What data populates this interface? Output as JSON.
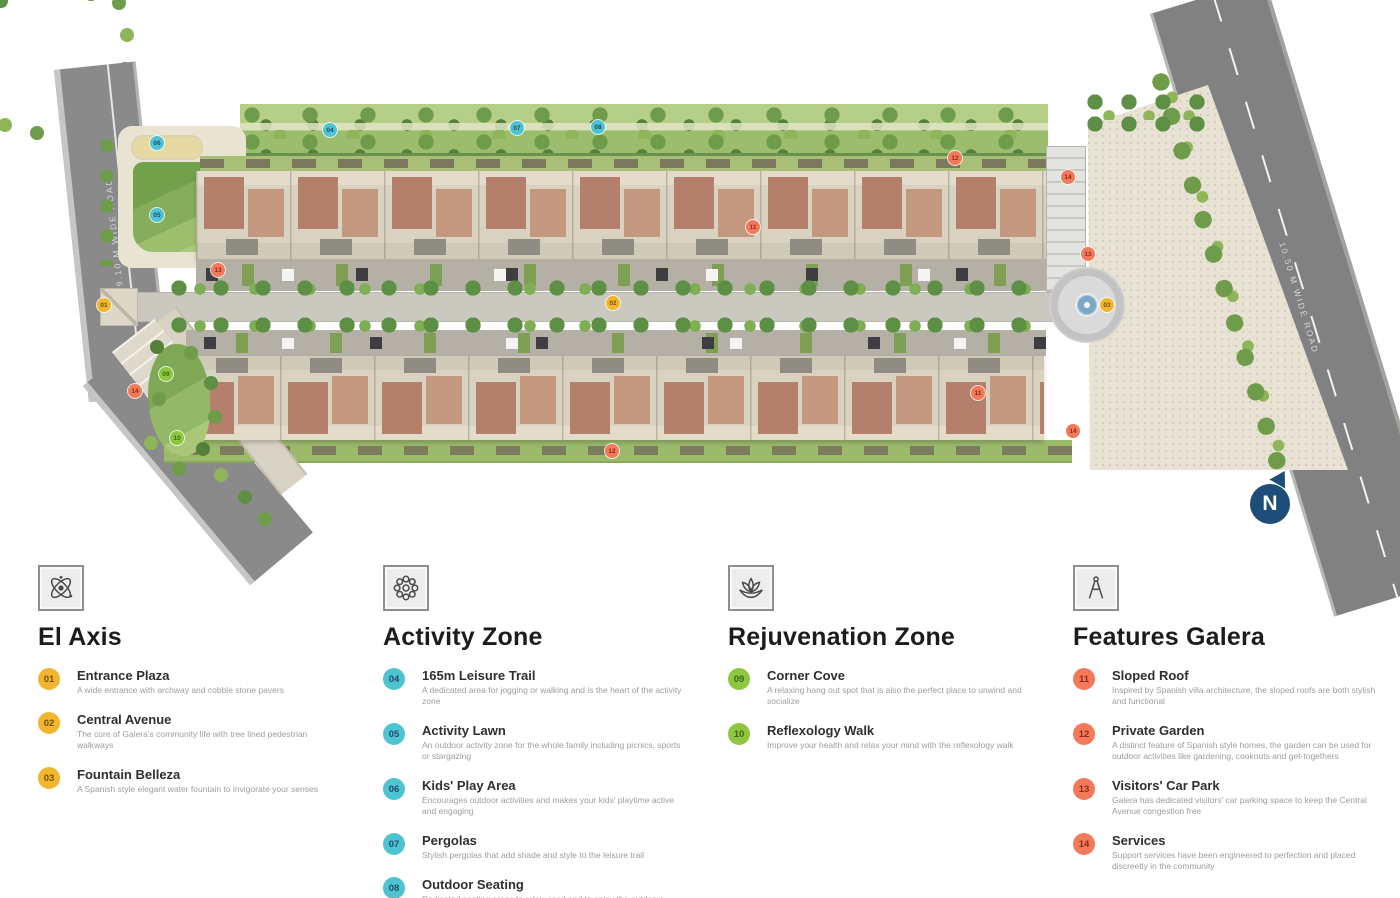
{
  "map": {
    "road_left_label": "9.10 M WIDE ROAD",
    "road_right_label": "10.50 M WIDE ROAD",
    "north_label": "N",
    "markers": [
      {
        "num": "01",
        "x": 104,
        "y": 305,
        "color": "#F2B52E",
        "text_color": "#6E5110"
      },
      {
        "num": "02",
        "x": 613,
        "y": 303,
        "color": "#F2B52E",
        "text_color": "#6E5110"
      },
      {
        "num": "03",
        "x": 1107,
        "y": 305,
        "color": "#F2B52E",
        "text_color": "#6E5110"
      },
      {
        "num": "04",
        "x": 330,
        "y": 130,
        "color": "#4FC4D1",
        "text_color": "#1F4A6E"
      },
      {
        "num": "05",
        "x": 157,
        "y": 215,
        "color": "#4FC4D1",
        "text_color": "#1F4A6E"
      },
      {
        "num": "06",
        "x": 157,
        "y": 143,
        "color": "#4FC4D1",
        "text_color": "#1F4A6E"
      },
      {
        "num": "07",
        "x": 517,
        "y": 128,
        "color": "#4FC4D1",
        "text_color": "#1F4A6E"
      },
      {
        "num": "08",
        "x": 598,
        "y": 127,
        "color": "#4FC4D1",
        "text_color": "#1F4A6E"
      },
      {
        "num": "09",
        "x": 166,
        "y": 374,
        "color": "#8DC63F",
        "text_color": "#3E651A"
      },
      {
        "num": "10",
        "x": 177,
        "y": 438,
        "color": "#8DC63F",
        "text_color": "#3E651A"
      },
      {
        "num": "11",
        "x": 753,
        "y": 227,
        "color": "#F3795A",
        "text_color": "#8E2B18"
      },
      {
        "num": "11",
        "x": 978,
        "y": 393,
        "color": "#F3795A",
        "text_color": "#8E2B18"
      },
      {
        "num": "12",
        "x": 955,
        "y": 158,
        "color": "#F3795A",
        "text_color": "#8E2B18"
      },
      {
        "num": "12",
        "x": 612,
        "y": 451,
        "color": "#F3795A",
        "text_color": "#8E2B18"
      },
      {
        "num": "13",
        "x": 218,
        "y": 270,
        "color": "#F3795A",
        "text_color": "#8E2B18"
      },
      {
        "num": "13",
        "x": 1088,
        "y": 254,
        "color": "#F3795A",
        "text_color": "#8E2B18"
      },
      {
        "num": "14",
        "x": 1068,
        "y": 177,
        "color": "#F3795A",
        "text_color": "#8E2B18"
      },
      {
        "num": "14",
        "x": 135,
        "y": 391,
        "color": "#F3795A",
        "text_color": "#8E2B18"
      },
      {
        "num": "14",
        "x": 1073,
        "y": 431,
        "color": "#F3795A",
        "text_color": "#8E2B18"
      }
    ]
  },
  "legend": {
    "sections": [
      {
        "title": "El Axis",
        "icon": "axis-icon",
        "chip_color": "#F2B52E",
        "chip_num_color": "#6E5110",
        "items": [
          {
            "num": "01",
            "name": "Entrance Plaza",
            "desc": "A wide entrance with archway and cobble stone pavers"
          },
          {
            "num": "02",
            "name": "Central Avenue",
            "desc": "The core of Galera's community life with tree lined pedestrian walkways"
          },
          {
            "num": "03",
            "name": "Fountain Belleza",
            "desc": "A Spanish style elegant water fountain to invigorate your senses"
          }
        ]
      },
      {
        "title": "Activity Zone",
        "icon": "activity-zone-icon",
        "chip_color": "#4FC4D1",
        "chip_num_color": "#1F4A6E",
        "items": [
          {
            "num": "04",
            "name": "165m Leisure Trail",
            "desc": "A dedicated area for jogging or walking and is the heart of the activity zone"
          },
          {
            "num": "05",
            "name": "Activity Lawn",
            "desc": "An outdoor activity zone for the whole family including picnics, sports or stargazing"
          },
          {
            "num": "06",
            "name": "Kids' Play Area",
            "desc": "Encourages outdoor activities and makes your kids' playtime active and engaging"
          },
          {
            "num": "07",
            "name": "Pergolas",
            "desc": "Stylish pergolas that add shade and style to the leisure trail"
          },
          {
            "num": "08",
            "name": "Outdoor Seating",
            "desc": "Dedicated seating areas to relax, read and to enjoy the outdoors"
          }
        ]
      },
      {
        "title": "Rejuvenation Zone",
        "icon": "rejuvenation-icon",
        "chip_color": "#8DC63F",
        "chip_num_color": "#3E651A",
        "items": [
          {
            "num": "09",
            "name": "Corner Cove",
            "desc": "A relaxing hang out spot that is also the perfect place to unwind and socialize"
          },
          {
            "num": "10",
            "name": "Reflexology Walk",
            "desc": "Improve your health and relax your mind with the reflexology walk"
          }
        ]
      },
      {
        "title": "Features Galera",
        "icon": "features-icon",
        "chip_color": "#F3795A",
        "chip_num_color": "#8E2B18",
        "items": [
          {
            "num": "11",
            "name": "Sloped Roof",
            "desc": "Inspired by Spanish villa architecture, the sloped roofs are both stylish and functional"
          },
          {
            "num": "12",
            "name": "Private Garden",
            "desc": "A distinct feature of Spanish style homes, the garden can be used for outdoor activities like gardening, cookouts and get-togethers"
          },
          {
            "num": "13",
            "name": "Visitors' Car Park",
            "desc": "Galera has dedicated visitors' car parking space to keep the Central Avenue congestion free"
          },
          {
            "num": "14",
            "name": "Services",
            "desc": "Support services have been engineered to perfection and placed discreetly in the community"
          }
        ]
      }
    ]
  },
  "palette": {
    "axis_yellow": "#F2B52E",
    "activity_cyan": "#4FC4D1",
    "rejuvenation_green": "#8DC63F",
    "features_coral": "#F3795A",
    "compass_blue": "#1D4E79",
    "road_gray": "#8A8A8A",
    "roof_terracotta": "#B5806B",
    "grass_green": "#9CBC6E"
  }
}
